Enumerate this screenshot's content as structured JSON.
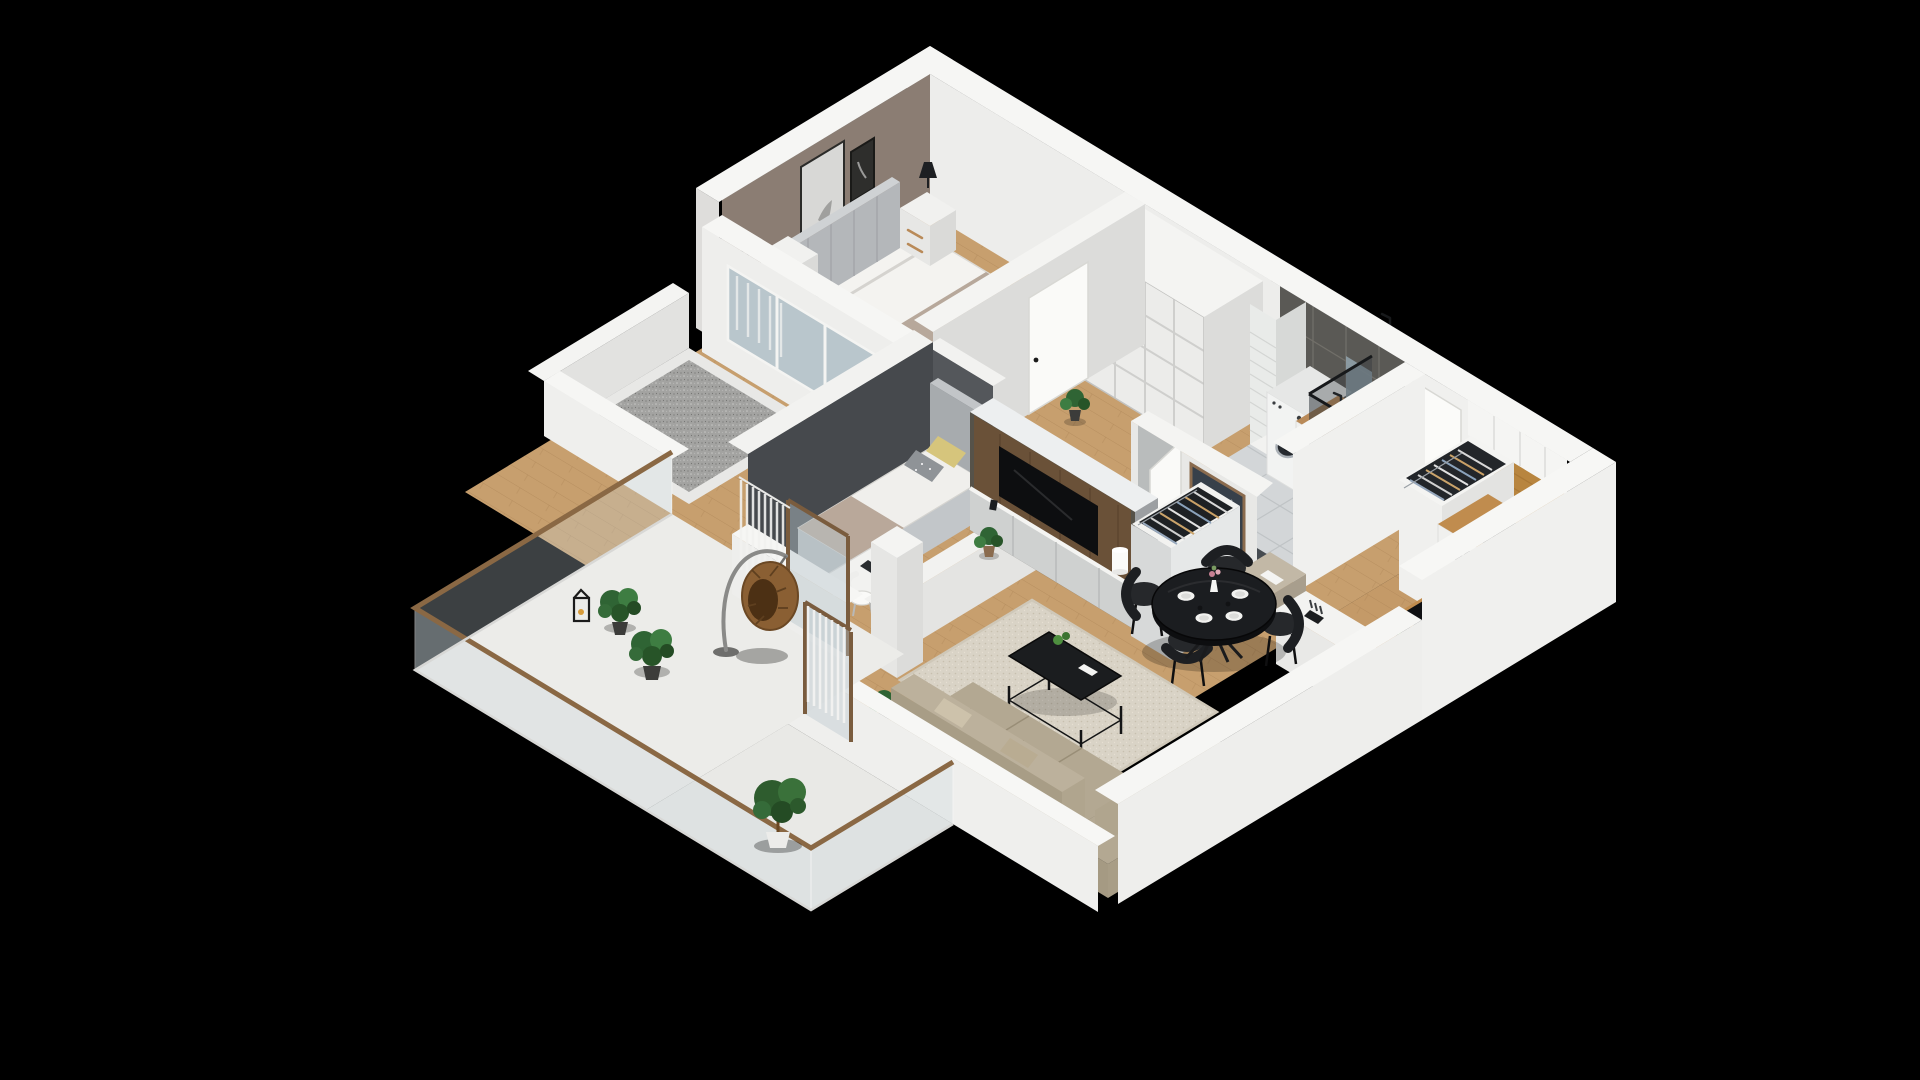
{
  "scene": {
    "title": "3D isometric cutaway floor plan render of a two-bedroom apartment on a black background",
    "background": "#000000",
    "projection": "isometric dollhouse view"
  },
  "palette": {
    "background": "#000000",
    "exterior_wall": "#f4f4f2",
    "interior_wall": "#e6e6e4",
    "accent_wall_taupe": "#8b7d73",
    "wall_charcoal": "#46494d",
    "bathroom_tile_graphite": "#5a5955",
    "wood_floor": "#c79f6e",
    "oak_cabinet": "#b8853f",
    "balcony_floor": "#ecece9",
    "terrace_gravel": "#a3a3a1",
    "window_glass": "#b9c6cc",
    "sofa_beige": "#b3a892",
    "rug_beige": "#d9d3c6",
    "furniture_black": "#1b1d20",
    "plant_green": "#3a7a3a",
    "rattan_brown": "#8a5f33",
    "handrail_wood": "#8a6844"
  },
  "rooms": [
    {
      "id": "master-bedroom",
      "label": "Master bedroom",
      "items": [
        "double bed with white duvet",
        "gray upholstered headboard",
        "patterned pillows",
        "two white nightstands",
        "black table lamp",
        "thin floor lamp",
        "white dresser with decor",
        "taupe accent wall with three picture frames",
        "potted fern",
        "window wall to terrace with sheer curtains"
      ]
    },
    {
      "id": "built-in-wardrobe",
      "label": "Built-in wardrobe",
      "items": [
        "white grid-panel sliding doors"
      ]
    },
    {
      "id": "bathroom",
      "label": "Bathroom",
      "items": [
        "graphite tiled walls",
        "glass shower enclosure",
        "white washing machine with round door",
        "vanity cabinet with wood top and sink",
        "mirror",
        "white tiled duct column",
        "tile floor with dark mosaic strip",
        "white door ajar"
      ]
    },
    {
      "id": "entry-hall",
      "label": "Entry hall",
      "items": [
        "white entrance door with black handle",
        "open coat closet with hangers",
        "framed mirror",
        "beige ottoman",
        "wood plank floor"
      ]
    },
    {
      "id": "kitchen",
      "label": "Kitchen",
      "items": [
        "white base and upper cabinets",
        "oak backsplash panel",
        "black induction hob with four burners",
        "built-in oven",
        "black coffee machine",
        "pepper mills",
        "black undermount sink",
        "bowl of green apples",
        "knife block",
        "white peninsula counter"
      ]
    },
    {
      "id": "living-room",
      "label": "Living room",
      "items": [
        "dark wood TV panel wall",
        "flat screen TV",
        "gray-white media lowboard",
        "white drum table lamp",
        "black metal coffee table with plant",
        "beige speckled rug",
        "large beige corner sofa with cushions",
        "open hanger wardrobe",
        "white structural column",
        "balcony door with sheer curtains"
      ]
    },
    {
      "id": "dining-area",
      "label": "Dining area",
      "items": [
        "round black dining table",
        "four black shell chairs",
        "white place settings",
        "vase with flowers"
      ]
    },
    {
      "id": "second-bedroom",
      "label": "Second bedroom",
      "items": [
        "gray daybed with white bedding",
        "yellow and dotted gray pillows",
        "white desk with chair",
        "charcoal feature wall",
        "potted plant",
        "balcony window with curtains"
      ]
    },
    {
      "id": "balcony",
      "label": "Wrap-around balcony",
      "items": [
        "white floor slab",
        "glass railing with wood handrail",
        "hanging rattan egg chair on stand",
        "two leafy potted plants",
        "black candle lantern",
        "potted tree in white planter"
      ]
    },
    {
      "id": "terrace",
      "label": "Gravel terrace",
      "items": [
        "gray gravel infill",
        "white ledge and parapet"
      ]
    }
  ],
  "counts": {
    "dining_chairs": 4,
    "dining_plates": 4,
    "wardrobe_door_panels": 16,
    "hob_burners": 4,
    "wall_frames": 3,
    "bed_pillows": 4,
    "balcony_plants": 3,
    "hanger_racks": 2
  }
}
